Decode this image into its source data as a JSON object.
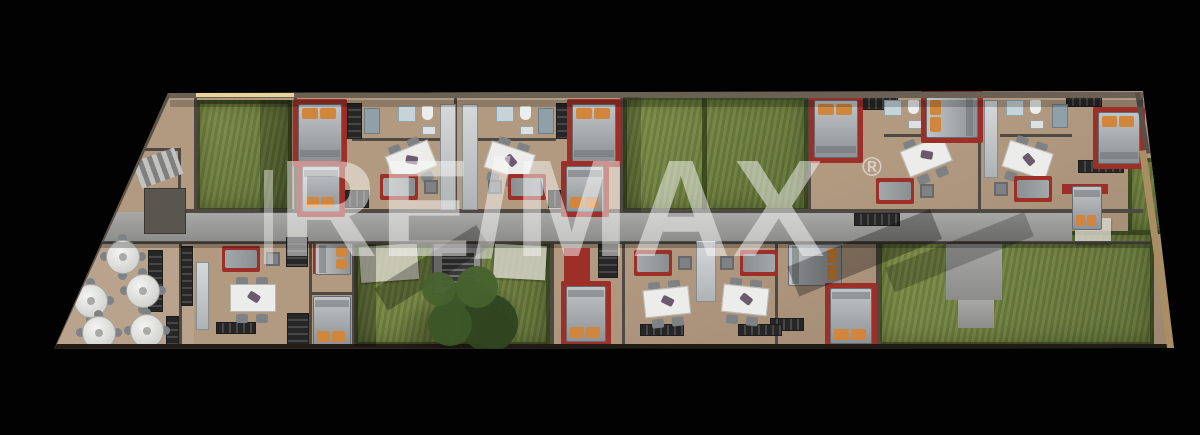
{
  "watermark": {
    "text": "RE/MAX",
    "registered_mark": "®"
  },
  "palette": {
    "background": "#020202",
    "floor": "#b29a81",
    "floor_dark": "#97816b",
    "wall": "#4e4a43",
    "wall_top": "#6a6053",
    "wall_bottom": "#221c16",
    "planter_wall": "#a98e63",
    "highlight": "#e7d49a",
    "grass": "#7d8f47",
    "grass_dark": "#5e6f35",
    "hedge": "#2a3614",
    "corridor": "#9b9b99",
    "accent_red": "#9c2f28",
    "mattress_light": "#c2c5c7",
    "mattress_dark": "#8e9295",
    "pillow": "#d0863c",
    "table_white": "#ececea",
    "chair_gray": "#7e8285",
    "cabinet_dark": "#262626",
    "fixture_white": "#eceeee",
    "shower_blue": "#c6d3d8",
    "tree_dark": "#2f4520",
    "tree_mid": "#3c5627",
    "tree_light": "#48622e",
    "stone": "#8d8d8b"
  },
  "floorplan": {
    "outline": [
      [
        168,
        93
      ],
      [
        1143,
        91
      ],
      [
        1174,
        348
      ],
      [
        54,
        349
      ]
    ],
    "restaurant_floor": [
      54,
      228,
      140,
      118
    ],
    "lawns": [
      {
        "x": 196,
        "y": 100,
        "w": 96,
        "h": 112
      },
      {
        "x": 623,
        "y": 96,
        "w": 185,
        "h": 116,
        "divider_x": 702
      },
      {
        "x": 354,
        "y": 244,
        "w": 196,
        "h": 102
      },
      {
        "x": 878,
        "y": 231,
        "w": 276,
        "h": 115
      },
      {
        "x": 1128,
        "y": 158,
        "w": 36,
        "h": 76
      }
    ],
    "corridor": {
      "main": [
        78,
        212,
        994,
        30
      ],
      "extensions": [
        [
          946,
          242,
          56,
          58
        ],
        [
          958,
          300,
          36,
          28
        ]
      ]
    },
    "stair_box": [
      432,
      241,
      50,
      54
    ],
    "stairwell": {
      "steps": [
        136,
        154,
        44,
        28
      ],
      "room": [
        144,
        188,
        42,
        46
      ]
    },
    "terrace_slabs": [
      [
        360,
        245,
        58,
        36,
        -4
      ],
      [
        494,
        245,
        52,
        34,
        3
      ],
      [
        1075,
        218,
        36,
        26,
        0
      ]
    ],
    "walls": [
      [
        294,
        97,
        3,
        114
      ],
      [
        454,
        97,
        3,
        114
      ],
      [
        620,
        97,
        3,
        114
      ],
      [
        808,
        95,
        3,
        118
      ],
      [
        978,
        95,
        3,
        116
      ],
      [
        1140,
        93,
        3,
        62
      ],
      [
        194,
        97,
        3,
        114
      ],
      [
        352,
        138,
        102,
        3
      ],
      [
        462,
        138,
        94,
        3
      ],
      [
        884,
        134,
        62,
        3
      ],
      [
        1000,
        134,
        72,
        3
      ],
      [
        168,
        209,
        975,
        4
      ],
      [
        78,
        241,
        1072,
        3
      ],
      [
        179,
        241,
        3,
        106
      ],
      [
        309,
        241,
        3,
        106
      ],
      [
        311,
        292,
        41,
        3
      ],
      [
        352,
        241,
        4,
        106
      ],
      [
        550,
        241,
        4,
        106
      ],
      [
        622,
        241,
        3,
        106
      ],
      [
        775,
        241,
        3,
        106
      ],
      [
        876,
        241,
        4,
        104
      ],
      [
        178,
        148,
        3,
        62
      ],
      [
        134,
        148,
        46,
        3
      ]
    ],
    "edges": {
      "top": [
        166,
        92,
        980,
        6
      ],
      "highlight": [
        196,
        93,
        98,
        4
      ],
      "bottom": [
        54,
        344,
        1116,
        6
      ],
      "left_diag": {
        "x": 170,
        "y": 96,
        "len": 274,
        "rot": 114.5
      },
      "right_diag_dark": {
        "x": 1140,
        "y": 92,
        "len": 62,
        "rot": 80.6
      },
      "right_diag_tan": {
        "x": 1146,
        "y": 150,
        "len": 200,
        "rot": 81.9
      }
    },
    "furniture": {
      "beds": [
        {
          "x": 298,
          "y": 104,
          "w": 44,
          "h": 58,
          "dir": "v",
          "pillow": "start"
        },
        {
          "x": 302,
          "y": 166,
          "w": 38,
          "h": 46,
          "dir": "v",
          "pillow": "end"
        },
        {
          "x": 572,
          "y": 104,
          "w": 44,
          "h": 58,
          "dir": "v",
          "pillow": "start"
        },
        {
          "x": 566,
          "y": 166,
          "w": 38,
          "h": 46,
          "dir": "v",
          "pillow": "end"
        },
        {
          "x": 814,
          "y": 100,
          "w": 44,
          "h": 58,
          "dir": "v",
          "pillow": "start"
        },
        {
          "x": 926,
          "y": 96,
          "w": 52,
          "h": 42,
          "dir": "h",
          "pillow": "start"
        },
        {
          "x": 1098,
          "y": 112,
          "w": 42,
          "h": 52,
          "dir": "v",
          "pillow": "start"
        },
        {
          "x": 1072,
          "y": 186,
          "w": 30,
          "h": 44,
          "dir": "v",
          "pillow": "end",
          "rug": false
        },
        {
          "x": 315,
          "y": 243,
          "w": 36,
          "h": 32,
          "dir": "h",
          "pillow": "end",
          "rug": false
        },
        {
          "x": 313,
          "y": 296,
          "w": 38,
          "h": 50,
          "dir": "v",
          "pillow": "end",
          "rug": false
        },
        {
          "x": 566,
          "y": 286,
          "w": 40,
          "h": 56,
          "dir": "v",
          "pillow": "end"
        },
        {
          "x": 788,
          "y": 244,
          "w": 54,
          "h": 42,
          "dir": "h",
          "pillow": "end",
          "rug": false
        },
        {
          "x": 830,
          "y": 288,
          "w": 42,
          "h": 56,
          "dir": "v",
          "pillow": "end"
        }
      ],
      "dining_sets": [
        [
          385,
          143,
          -22
        ],
        [
          482,
          143,
          18
        ],
        [
          900,
          138,
          -22
        ],
        [
          1000,
          142,
          18
        ],
        [
          226,
          280,
          0
        ],
        [
          640,
          284,
          -6
        ],
        [
          718,
          282,
          6
        ]
      ],
      "sofa_sets": [
        [
          380,
          174,
          0
        ],
        [
          490,
          174,
          1
        ],
        [
          876,
          178,
          0
        ],
        [
          996,
          176,
          1
        ],
        [
          222,
          246,
          0
        ],
        [
          634,
          250,
          0
        ],
        [
          722,
          250,
          1
        ]
      ],
      "red_accents": [
        [
          313,
          244,
          10,
          30
        ],
        [
          313,
          298,
          9,
          14
        ],
        [
          564,
          248,
          26,
          38
        ],
        [
          1062,
          184,
          46,
          10
        ],
        [
          293,
          130,
          16,
          32
        ],
        [
          604,
          130,
          16,
          32
        ]
      ],
      "bath_clusters": [
        [
          398,
          106
        ],
        [
          496,
          106
        ],
        [
          884,
          100
        ],
        [
          1006,
          100
        ]
      ],
      "kitchen_strips": [
        [
          440,
          104,
          16,
          106
        ],
        [
          462,
          104,
          16,
          106
        ],
        [
          984,
          100,
          14,
          78
        ],
        [
          696,
          240,
          20,
          62
        ],
        [
          196,
          262,
          13,
          68
        ]
      ],
      "dark_cabinets": [
        [
          347,
          103,
          15,
          36
        ],
        [
          556,
          103,
          15,
          36
        ],
        [
          343,
          190,
          26,
          18
        ],
        [
          548,
          190,
          26,
          18
        ],
        [
          862,
          97,
          36,
          13
        ],
        [
          1066,
          94,
          36,
          13
        ],
        [
          1078,
          160,
          46,
          13
        ],
        [
          854,
          213,
          46,
          13
        ],
        [
          286,
          237,
          22,
          30
        ],
        [
          287,
          313,
          22,
          32
        ],
        [
          216,
          322,
          40,
          12
        ],
        [
          181,
          246,
          12,
          60
        ],
        [
          148,
          250,
          15,
          62
        ],
        [
          166,
          316,
          13,
          30
        ],
        [
          770,
          318,
          34,
          13
        ],
        [
          640,
          324,
          44,
          12
        ],
        [
          738,
          324,
          44,
          12
        ],
        [
          598,
          244,
          20,
          34
        ]
      ],
      "teal_cabinets": [
        [
          364,
          108,
          16,
          26
        ],
        [
          538,
          108,
          16,
          26
        ],
        [
          1052,
          104,
          16,
          24
        ]
      ],
      "round_tables": [
        [
          106,
          240
        ],
        [
          126,
          274
        ],
        [
          74,
          284
        ],
        [
          82,
          316
        ],
        [
          130,
          314
        ]
      ]
    },
    "tree": {
      "cx": 472,
      "cy": 314,
      "r": 46
    },
    "shadows": [
      [
        78,
        242,
        1072,
        6,
        0.25,
        0
      ],
      [
        170,
        100,
        976,
        7,
        0.2,
        0
      ],
      [
        260,
        100,
        33,
        112,
        0.22,
        0
      ],
      [
        623,
        97,
        18,
        115,
        0.18,
        0
      ],
      [
        354,
        244,
        22,
        102,
        0.28,
        0
      ],
      [
        470,
        236,
        26,
        120,
        0.28,
        58
      ],
      [
        920,
        224,
        32,
        154,
        0.3,
        68
      ],
      [
        1016,
        224,
        26,
        150,
        0.22,
        68
      ]
    ]
  }
}
